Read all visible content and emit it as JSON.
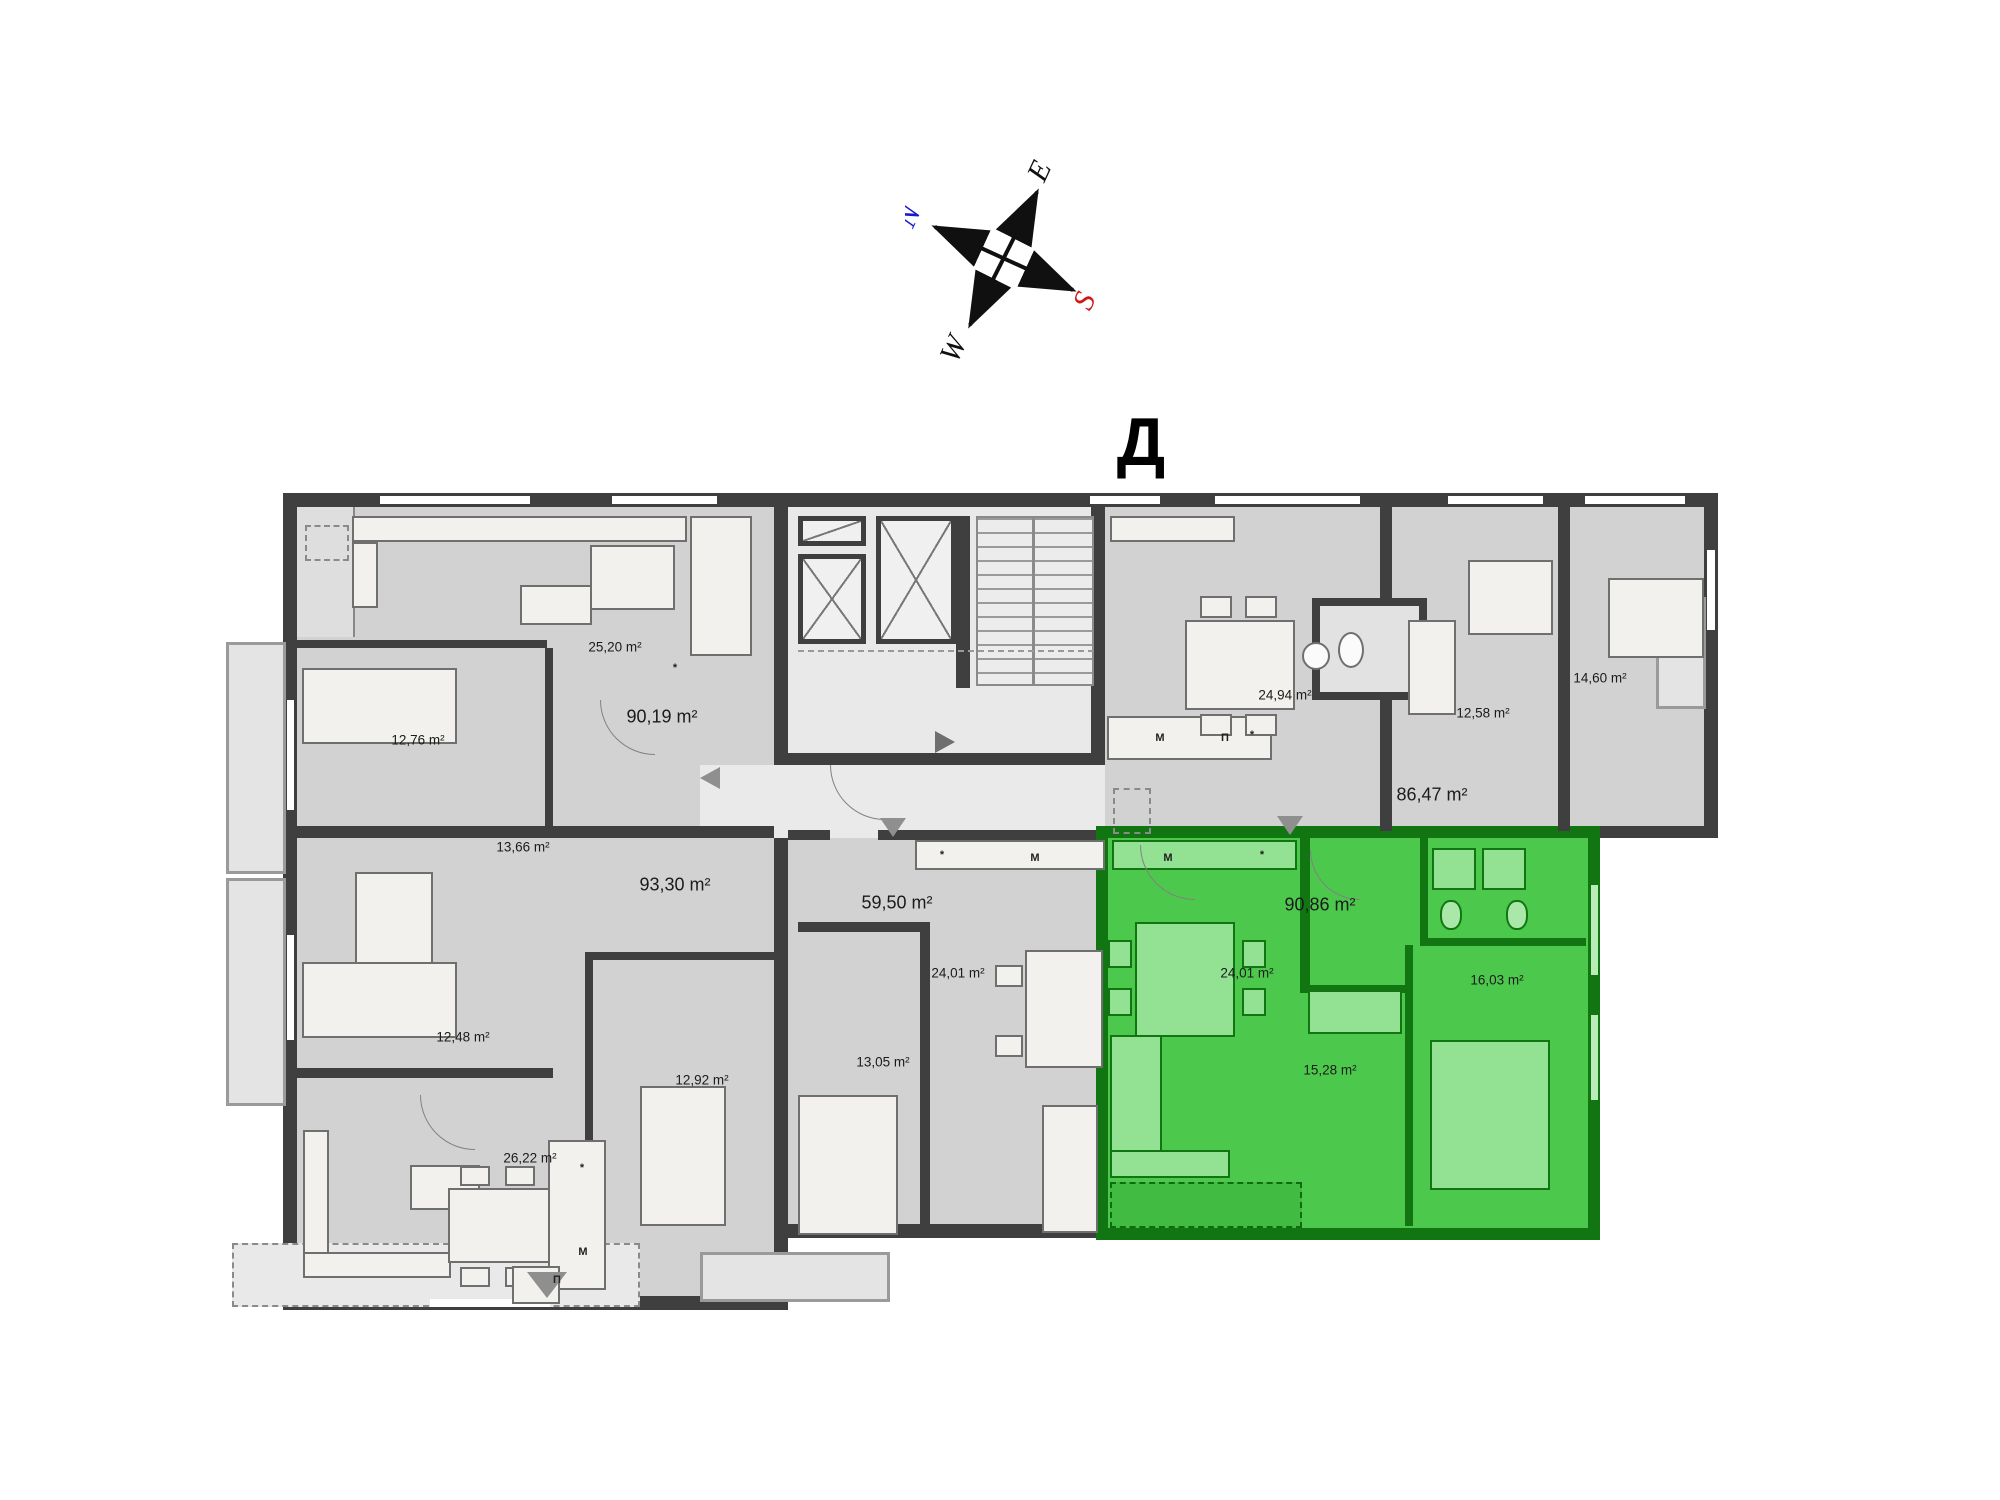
{
  "page": {
    "block_label": "Д"
  },
  "compass": {
    "north": "N",
    "east": "E",
    "south": "S",
    "west": "W",
    "north_color": "#1a1acc",
    "south_color": "#d01616",
    "axis_color": "#101010"
  },
  "floor_plan": {
    "highlight_color": "#4cc94c",
    "floor_color": "#d2d2d2",
    "wall_color": "#3f3f3f",
    "area_labels": [
      {
        "text": "25,20 m²",
        "x": 615,
        "y": 647,
        "size": "sm"
      },
      {
        "text": "90,19 m²",
        "x": 662,
        "y": 717,
        "size": "lg"
      },
      {
        "text": "12,76 m²",
        "x": 418,
        "y": 740,
        "size": "sm"
      },
      {
        "text": "13,66 m²",
        "x": 523,
        "y": 847,
        "size": "sm"
      },
      {
        "text": "93,30 m²",
        "x": 675,
        "y": 885,
        "size": "lg"
      },
      {
        "text": "59,50 m²",
        "x": 897,
        "y": 903,
        "size": "lg"
      },
      {
        "text": "24,01 m²",
        "x": 958,
        "y": 973,
        "size": "sm"
      },
      {
        "text": "13,05 m²",
        "x": 883,
        "y": 1062,
        "size": "sm"
      },
      {
        "text": "12,48 m²",
        "x": 463,
        "y": 1037,
        "size": "sm"
      },
      {
        "text": "12,92 m²",
        "x": 702,
        "y": 1080,
        "size": "sm"
      },
      {
        "text": "26,22 m²",
        "x": 530,
        "y": 1158,
        "size": "sm"
      },
      {
        "text": "24,94 m²",
        "x": 1285,
        "y": 695,
        "size": "sm"
      },
      {
        "text": "12,58 m²",
        "x": 1483,
        "y": 713,
        "size": "sm"
      },
      {
        "text": "86,47 m²",
        "x": 1432,
        "y": 795,
        "size": "lg"
      },
      {
        "text": "14,60 m²",
        "x": 1600,
        "y": 678,
        "size": "sm"
      },
      {
        "text": "90,86 m²",
        "x": 1320,
        "y": 905,
        "size": "lg"
      },
      {
        "text": "24,01 m²",
        "x": 1247,
        "y": 973,
        "size": "sm"
      },
      {
        "text": "16,03 m²",
        "x": 1497,
        "y": 980,
        "size": "sm"
      },
      {
        "text": "15,28 m²",
        "x": 1330,
        "y": 1070,
        "size": "sm"
      }
    ],
    "appliance_labels": [
      {
        "text": "*",
        "x": 675,
        "y": 668
      },
      {
        "text": "*",
        "x": 942,
        "y": 855
      },
      {
        "text": "M",
        "x": 1035,
        "y": 858
      },
      {
        "text": "M",
        "x": 1160,
        "y": 738
      },
      {
        "text": "П",
        "x": 1225,
        "y": 738
      },
      {
        "text": "*",
        "x": 1252,
        "y": 735
      },
      {
        "text": "M",
        "x": 1168,
        "y": 858
      },
      {
        "text": "*",
        "x": 1262,
        "y": 855
      },
      {
        "text": "*",
        "x": 582,
        "y": 1168
      },
      {
        "text": "M",
        "x": 583,
        "y": 1252
      },
      {
        "text": "П",
        "x": 557,
        "y": 1280
      }
    ]
  }
}
